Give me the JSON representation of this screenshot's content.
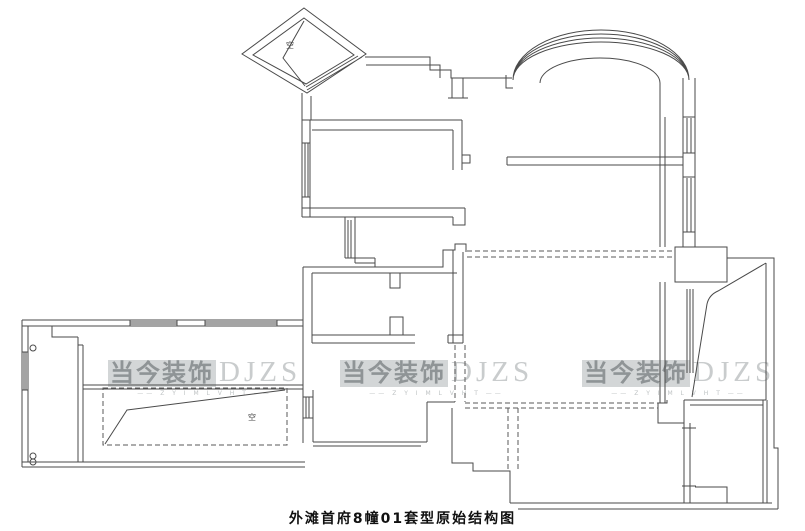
{
  "title": "外滩首府8幢01套型原始结构图",
  "watermark": {
    "brand": "当今装饰",
    "logo": "DJZS",
    "tagline": "—— Z Y I M  L V H T ——",
    "positions": [
      {
        "left": 108,
        "top": 358
      },
      {
        "left": 340,
        "top": 358
      },
      {
        "left": 582,
        "top": 358
      }
    ]
  },
  "colors": {
    "wall": "#4a4a4a",
    "dashed": "#5a5a5a",
    "watermark_text": "#8f9496",
    "watermark_logo": "#c9cccd",
    "title_text": "#111111",
    "background": "#ffffff"
  },
  "plan": {
    "labels": [
      {
        "text": "空",
        "x": 286,
        "y": 48
      },
      {
        "text": "空",
        "x": 248,
        "y": 420
      }
    ],
    "circles": [
      {
        "cx": 33,
        "cy": 348,
        "r": 3
      },
      {
        "cx": 33,
        "cy": 456,
        "r": 3
      },
      {
        "cx": 33,
        "cy": 462,
        "r": 3
      }
    ],
    "solid": [
      {
        "name": "diamond-bay-window",
        "d": "M304,8 L366,54 L307,93 L242,54 Z M304,18 L354,55 L306,84 L253,55 Z M362,57 L307,90 M358,56 L306,87"
      },
      {
        "name": "diamond-door-flap",
        "d": "M304,21 L283,58 L305,86"
      },
      {
        "name": "entry-corridor-wall",
        "d": "M302,95 V120 M311,96 V120"
      },
      {
        "name": "north-wall",
        "d": "M365,57 H430 V70 H451 V78 H512 M366,65 H440 V78"
      },
      {
        "name": "north-wall-cap",
        "d": "M452,78 V98 M463,78 V98 M448,98 H468"
      },
      {
        "name": "arch-window-band",
        "d": "M513,80 A88,50 0 0 1 689,80 M513,80 A88,46 0 0 1 689,80 M513,80 A88,42 0 0 1 689,80 M513,80 A88,38 0 0 1 689,80 M506,75 V88 H513"
      },
      {
        "name": "arch-inner-wall",
        "d": "M540,83 A60,25 0 0 1 660,83 M660,83 V247 M665,117 V247"
      },
      {
        "name": "east-wall-upper",
        "d": "M683,78 V247 M695,78 V247 M683,117 H695 M683,153 H695 M683,177 H695 M683,232 H695 M687,118 V153 M691,118 V153 M687,178 V232 M691,178 V232"
      },
      {
        "name": "living-partition-wall",
        "d": "M507,157 H683 M507,165 H683 M507,157 V165"
      },
      {
        "name": "upper-pier",
        "d": "M675,247 H727 V282 H675 Z"
      },
      {
        "name": "east-outer-boundary",
        "d": "M727,258 H774 V448 H778 V509"
      },
      {
        "name": "east-wall-mid",
        "d": "M660,282 V403 M665,282 V403"
      },
      {
        "name": "stair-funnel",
        "d": "M766,263 L718,291 Q709,295 707,304 L692,397 M766,263 V400"
      },
      {
        "name": "stair-rail-hatch",
        "d": "M687,289 V373 M690,289 V373 M693,289 V373"
      },
      {
        "name": "lower-pier",
        "d": "M667,400 V403 H658 V423 H684 V400"
      },
      {
        "name": "east-wall-lower",
        "d": "M684,423 V503 M690,423 V503 M682,428 H696 M682,486 H696"
      },
      {
        "name": "southeast-room",
        "d": "M684,400 H766 M690,405 H763 M763,400 V503 M767,400 V503 M695,487 H727 V503"
      },
      {
        "name": "south-wall-right",
        "d": "M510,503 H772 M518,509 H778"
      },
      {
        "name": "step-wall-center",
        "d": "M452,408 V463 H473 V471 H510 V503 M427,402 H455 M427,402 V442 M313,442 H427 M313,446 H421"
      },
      {
        "name": "bathroom-outline",
        "d": "M303,267 H443 V250 H455 V244 H466 V252 M312,273 H457 M303,267 V358 M312,273 V343 M312,335 H415 M312,343 H415 M453,250 V343 M463,252 V343 M448,335 H463 M448,343 H463 M448,335 V343"
      },
      {
        "name": "bathroom-stub-walls",
        "d": "M390,273 V288 H400 V273 M390,335 V317 H403 V335"
      },
      {
        "name": "bathroom-corridor-wall",
        "d": "M345,217 V258 M355,217 V263 M348,220 V258 M351,220 V258 M345,258 H375 M355,263 H375 M375,258 V267"
      },
      {
        "name": "middle-room",
        "d": "M302,120 H462 M312,130 H453 M302,93 V217 M310,120 V217 M302,143 H310 M302,197 H310 M305,143 V197 M308,143 V197 M462,120 V170 M453,130 V170 M462,155 H470 V163 H462 M302,208 H465 M302,217 H453 M453,217 V225 H465 V208"
      },
      {
        "name": "west-section-walls",
        "d": "M22,320 H303 M22,326 H303 M22,320 V467 M28,326 V462 M22,462 H305 M22,467 H305 M303,358 V443 M313,390 V442 M83,385 H303 M83,389 H303 M52,326 V337 H78 M78,337 V462 M83,345 V462 M78,345 H83"
      },
      {
        "name": "west-windows",
        "d": "M130,322 H177 M130,324 H177 M205,322 H277 M205,324 H277 M130,320 V326 M177,320 V326 M205,320 V326 M277,320 V326 M22,352 H28 M22,390 H28 M24,352 V390 M26,352 V390 M303,397 H313 M303,418 H313 M306,397 V418 M309,397 V418"
      },
      {
        "name": "void-diagonal",
        "d": "M105,444 L127,410 L285,390"
      }
    ],
    "dashed": [
      {
        "name": "dashed-beam-vertical-left",
        "d": "M455,345 V402 M465,345 V402"
      },
      {
        "name": "dashed-beam-horizontal",
        "d": "M465,403 H658 M465,408 H658"
      },
      {
        "name": "dashed-beam-vertical-right",
        "d": "M508,408 V470 M518,408 V470"
      },
      {
        "name": "dashed-beam-upper",
        "d": "M467,251 H675 M467,257 H675"
      },
      {
        "name": "void-outline",
        "d": "M103,388 H287 V445 H103 Z"
      }
    ]
  }
}
